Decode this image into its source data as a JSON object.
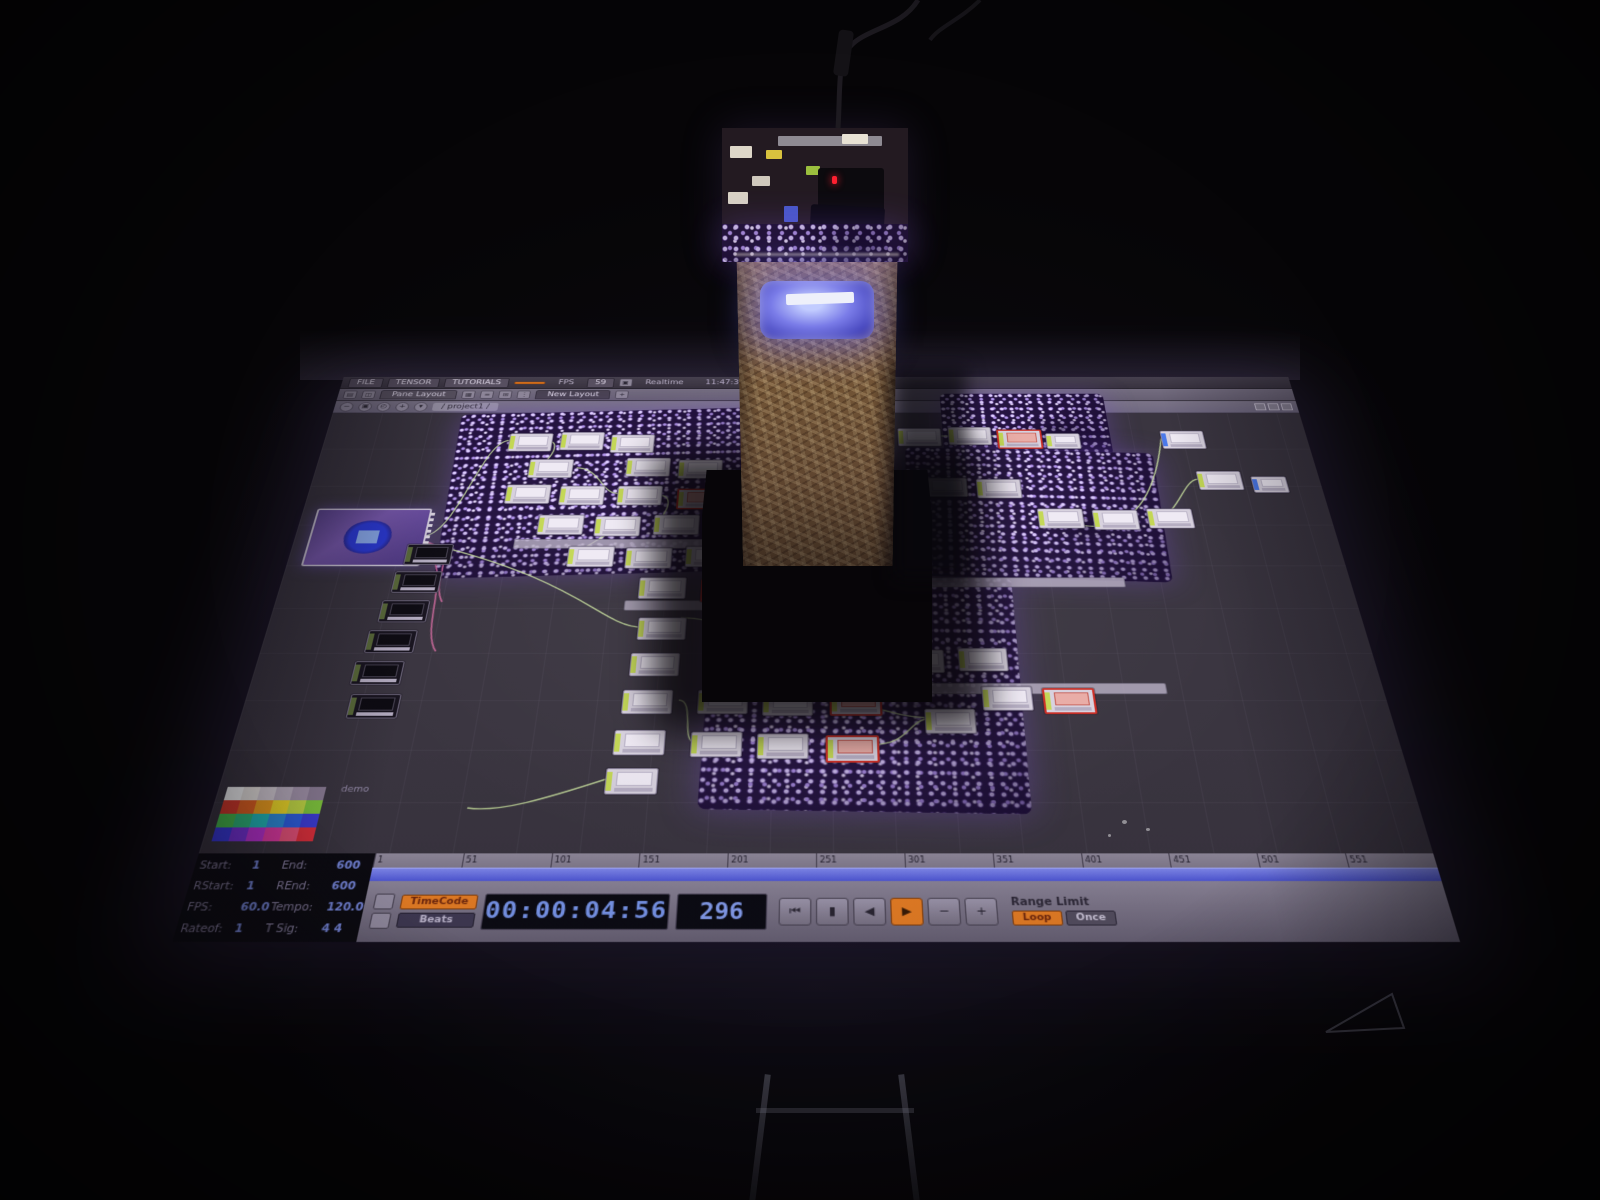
{
  "menubar": {
    "items": [
      "FILE",
      "TENSOR",
      "TUTORIALS"
    ],
    "alert_badge": "",
    "fps_label": "FPS",
    "fps_value": "59",
    "realtime_label": "Realtime",
    "status": "11:47:37 Opened window"
  },
  "layout_bar": {
    "tabs": [
      "Pane Layout",
      "New Layout"
    ],
    "add_label": "+"
  },
  "path_bar": {
    "breadcrumb": "/ project1 /"
  },
  "colors": {
    "accent_orange": "#ef8224",
    "timecode_blue": "#7d9cf5",
    "wire_green": "#cfe8a2",
    "dot_purple": "#b596f0"
  },
  "network": {
    "viewer_node": {
      "x": 15,
      "y": 205,
      "w": 118,
      "h": 76
    },
    "palette_label": "demo",
    "palette_rows": [
      [
        "#ffffff",
        "#efeae6",
        "#d8d0d8",
        "#bdb2c2",
        "#a697ae",
        "#90819a"
      ],
      [
        "#e03a2a",
        "#ea6420",
        "#f5a31e",
        "#f7e028",
        "#c8e046",
        "#84cf3e"
      ],
      [
        "#49c44e",
        "#2fbf7e",
        "#22bfc0",
        "#2f8fe0",
        "#2f62e8",
        "#3f3fe0"
      ],
      [
        "#3a3ae8",
        "#7a32e0",
        "#c032d8",
        "#e83ba8",
        "#f2557e",
        "#e8313d"
      ]
    ],
    "dot_fields": [
      {
        "x": 150,
        "y": 56,
        "w": 340,
        "h": 240,
        "rot": -2
      },
      {
        "x": 640,
        "y": 118,
        "w": 272,
        "h": 184,
        "rot": 2
      },
      {
        "x": 686,
        "y": 28,
        "w": 186,
        "h": 98,
        "rot": 0
      },
      {
        "x": 440,
        "y": 298,
        "w": 302,
        "h": 276,
        "rot": 1
      }
    ],
    "comment_bars": [
      {
        "x": 230,
        "y": 248,
        "w": 280
      },
      {
        "x": 352,
        "y": 330,
        "w": 240
      },
      {
        "x": 640,
        "y": 432,
        "w": 240
      },
      {
        "x": 648,
        "y": 300,
        "w": 210
      }
    ],
    "nodes": [
      {
        "x": 120,
        "y": 255,
        "k": "dark"
      },
      {
        "x": 114,
        "y": 292,
        "k": "dark"
      },
      {
        "x": 108,
        "y": 330,
        "k": "dark"
      },
      {
        "x": 102,
        "y": 368,
        "k": "dark"
      },
      {
        "x": 96,
        "y": 406,
        "k": "dark"
      },
      {
        "x": 100,
        "y": 445,
        "k": "dark"
      },
      {
        "x": 205,
        "y": 92
      },
      {
        "x": 262,
        "y": 90
      },
      {
        "x": 318,
        "y": 94
      },
      {
        "x": 232,
        "y": 132
      },
      {
        "x": 338,
        "y": 130
      },
      {
        "x": 395,
        "y": 133
      },
      {
        "x": 212,
        "y": 170
      },
      {
        "x": 270,
        "y": 172
      },
      {
        "x": 332,
        "y": 172
      },
      {
        "x": 396,
        "y": 176,
        "k": "error"
      },
      {
        "x": 452,
        "y": 174
      },
      {
        "x": 252,
        "y": 214
      },
      {
        "x": 312,
        "y": 216
      },
      {
        "x": 374,
        "y": 214
      },
      {
        "x": 438,
        "y": 218
      },
      {
        "x": 500,
        "y": 216,
        "k": "error"
      },
      {
        "x": 288,
        "y": 258
      },
      {
        "x": 348,
        "y": 260
      },
      {
        "x": 410,
        "y": 258
      },
      {
        "x": 474,
        "y": 262
      },
      {
        "x": 365,
        "y": 300
      },
      {
        "x": 428,
        "y": 302,
        "k": "error"
      },
      {
        "x": 636,
        "y": 84
      },
      {
        "x": 692,
        "y": 82
      },
      {
        "x": 746,
        "y": 86,
        "k": "error"
      },
      {
        "x": 800,
        "y": 92,
        "w": 36,
        "h": 22
      },
      {
        "x": 660,
        "y": 160
      },
      {
        "x": 718,
        "y": 162
      },
      {
        "x": 780,
        "y": 205
      },
      {
        "x": 838,
        "y": 207
      },
      {
        "x": 896,
        "y": 205
      },
      {
        "x": 928,
        "y": 88,
        "k": "blue"
      },
      {
        "x": 958,
        "y": 150
      },
      {
        "x": 1016,
        "y": 158,
        "k": "blue",
        "w": 36,
        "h": 22
      },
      {
        "x": 368,
        "y": 352
      },
      {
        "x": 364,
        "y": 396
      },
      {
        "x": 360,
        "y": 440
      },
      {
        "x": 356,
        "y": 486
      },
      {
        "x": 352,
        "y": 528
      },
      {
        "x": 432,
        "y": 440
      },
      {
        "x": 494,
        "y": 442
      },
      {
        "x": 558,
        "y": 440,
        "k": "error"
      },
      {
        "x": 428,
        "y": 488
      },
      {
        "x": 490,
        "y": 490
      },
      {
        "x": 554,
        "y": 492,
        "k": "error"
      },
      {
        "x": 648,
        "y": 462
      },
      {
        "x": 560,
        "y": 390
      },
      {
        "x": 622,
        "y": 392
      },
      {
        "x": 684,
        "y": 390
      },
      {
        "x": 704,
        "y": 436
      },
      {
        "x": 762,
        "y": 438,
        "k": "error"
      }
    ],
    "wires": [
      "M133,244 C168,244 175,105 205,103",
      "M251,105 C262,105 256,143 232,143",
      "M284,145 C310,145 314,183 332,183",
      "M378,186 C398,186 380,228 374,226",
      "M358,228 C330,228 300,270 288,270",
      "M133,252 C300,300 330,360 368,364",
      "M414,452 C430,452 418,500 432,500",
      "M540,452 C600,452 610,470 648,472",
      "M600,502 C630,502 634,476 648,474",
      "M682,96 C720,96 716,96 744,96",
      "M792,215 C850,250 900,230 928,100",
      "M904,217 C930,217 940,165 958,162",
      "M230,570 C260,575 300,560 352,540",
      "M410,352 C470,355 500,390 558,392"
    ],
    "cables_magenta": [
      "M133,250 C180,262 150,300 168,332",
      "M133,258 C176,282 150,362 172,394"
    ]
  },
  "timeline": {
    "field_rows": [
      [
        "Start:",
        "1",
        "End:",
        "600"
      ],
      [
        "RStart:",
        "1",
        "REnd:",
        "600"
      ],
      [
        "FPS:",
        "60.0",
        "Tempo:",
        "120.0"
      ],
      [
        "Rateof:",
        "1",
        "T Sig:",
        "4  4"
      ]
    ],
    "ruler_ticks": [
      "1",
      "51",
      "101",
      "151",
      "201",
      "251",
      "301",
      "351",
      "401",
      "451",
      "501",
      "551"
    ],
    "mode_buttons": [
      {
        "label": "TimeCode",
        "active": true
      },
      {
        "label": "Beats",
        "active": false
      }
    ],
    "timecode": "00:00:04:56",
    "frame": "296",
    "transport": [
      {
        "glyph": "⏮",
        "name": "jump-start"
      },
      {
        "glyph": "▮",
        "name": "pause"
      },
      {
        "glyph": "◀",
        "name": "play-reverse"
      },
      {
        "glyph": "▶",
        "name": "play",
        "active": true
      },
      {
        "glyph": "−",
        "name": "step-back"
      },
      {
        "glyph": "+",
        "name": "step-forward"
      }
    ],
    "range_limit_label": "Range Limit",
    "loop_buttons": [
      {
        "label": "Loop",
        "active": true
      },
      {
        "label": "Once",
        "active": false
      }
    ]
  }
}
